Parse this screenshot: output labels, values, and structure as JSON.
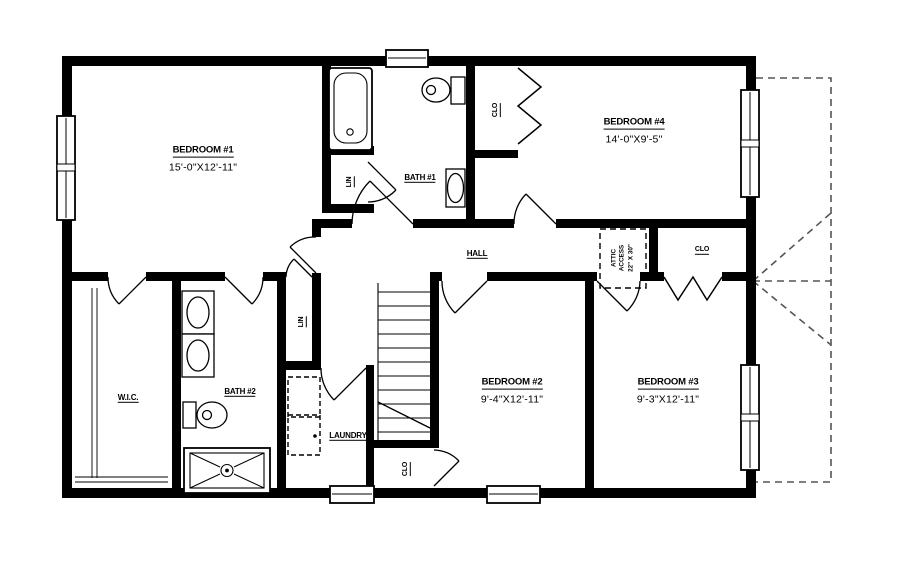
{
  "plan": {
    "type": "second-floor residential plan",
    "rooms": {
      "bedroom1": {
        "name": "BEDROOM #1",
        "dims": "15'-0\"X12'-11\""
      },
      "bedroom2": {
        "name": "BEDROOM #2",
        "dims": "9'-4\"X12'-11\""
      },
      "bedroom3": {
        "name": "BEDROOM #3",
        "dims": "9'-3\"X12'-11\""
      },
      "bedroom4": {
        "name": "BEDROOM #4",
        "dims": "14'-0\"X9'-5\""
      },
      "bath1": {
        "name": "BATH #1"
      },
      "bath2": {
        "name": "BATH #2"
      },
      "wic": {
        "name": "W.I.C."
      },
      "hall": {
        "name": "HALL"
      },
      "laundry": {
        "name": "LAUNDRY"
      },
      "closet_bed4": {
        "name": "CLO"
      },
      "closet_bed3": {
        "name": "CLO"
      },
      "closet_stairs": {
        "name": "CLO"
      },
      "linen1": {
        "name": "LIN"
      },
      "linen2": {
        "name": "LIN"
      },
      "attic_access": {
        "line1": "ATTIC",
        "line2": "ACCESS",
        "size": "22\" X 30\""
      }
    },
    "colors": {
      "wall": "#000000",
      "background": "#ffffff",
      "roof_dash": "#555555"
    }
  }
}
